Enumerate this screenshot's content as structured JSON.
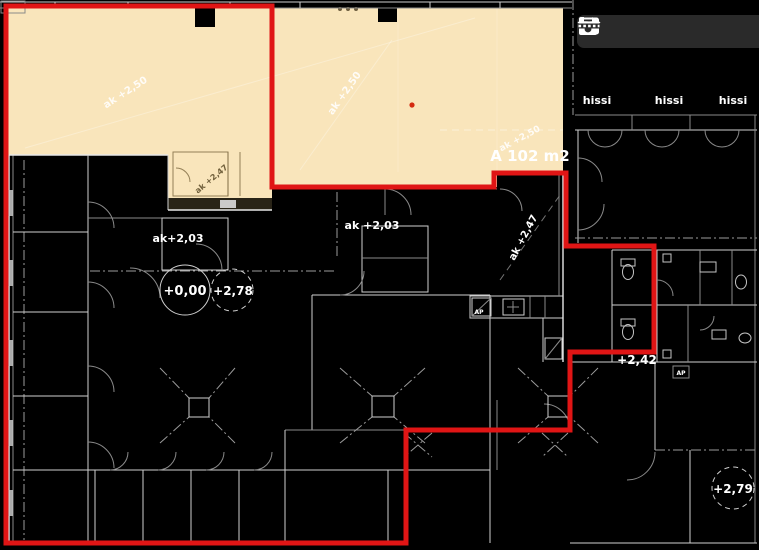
{
  "app": {
    "view": "floor-plan-annotator"
  },
  "toolbar": {
    "buttons": [
      {
        "id": "save",
        "icon": "save-icon"
      },
      {
        "id": "undo",
        "icon": "undo-icon"
      },
      {
        "id": "redo",
        "icon": "redo-icon"
      },
      {
        "id": "fit",
        "icon": "fit-selection-icon"
      }
    ]
  },
  "plan": {
    "elevators": [
      "hissi",
      "hissi",
      "hissi"
    ],
    "area_label": "A 102 m2",
    "ceiling_heights": {
      "beige_left": "ak +2,50",
      "beige_mid": "ak +2,50",
      "beige_right": "ak +2,50",
      "beige_room": "ak +2,47",
      "shaft": "ak +2,47",
      "left": "ak+2,03",
      "mid": "ak +2,03"
    },
    "floor_levels": {
      "origin": "+0,00",
      "right_of_origin": "+2,78",
      "bath": "+2,42",
      "bottom_right": "+2,79"
    },
    "equipment": {
      "ap_kitchen": "AP",
      "ap_bath": "AP"
    }
  },
  "colors": {
    "background": "#000000",
    "plan_line": "#cfcfcf",
    "highlight_fill": "#f9e5bb",
    "annotation_red": "#e01515",
    "toolbar_bg": "#2a2a2a",
    "icon": "#ffffff",
    "text": "#ffffff"
  }
}
